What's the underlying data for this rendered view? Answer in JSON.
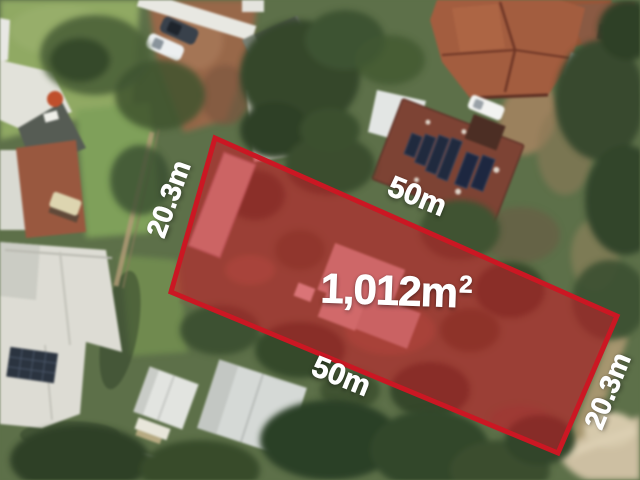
{
  "annotation": {
    "area": {
      "value": "1,012m",
      "exponent": "2"
    },
    "dimensions": {
      "left": "20.3m",
      "top": "50m",
      "bottom": "50m",
      "right": "20.3m"
    },
    "colors": {
      "boundary": "#cb1723",
      "parcel_fill": "rgba(206,23,38,0.55)",
      "label_text": "#ffffff"
    }
  }
}
